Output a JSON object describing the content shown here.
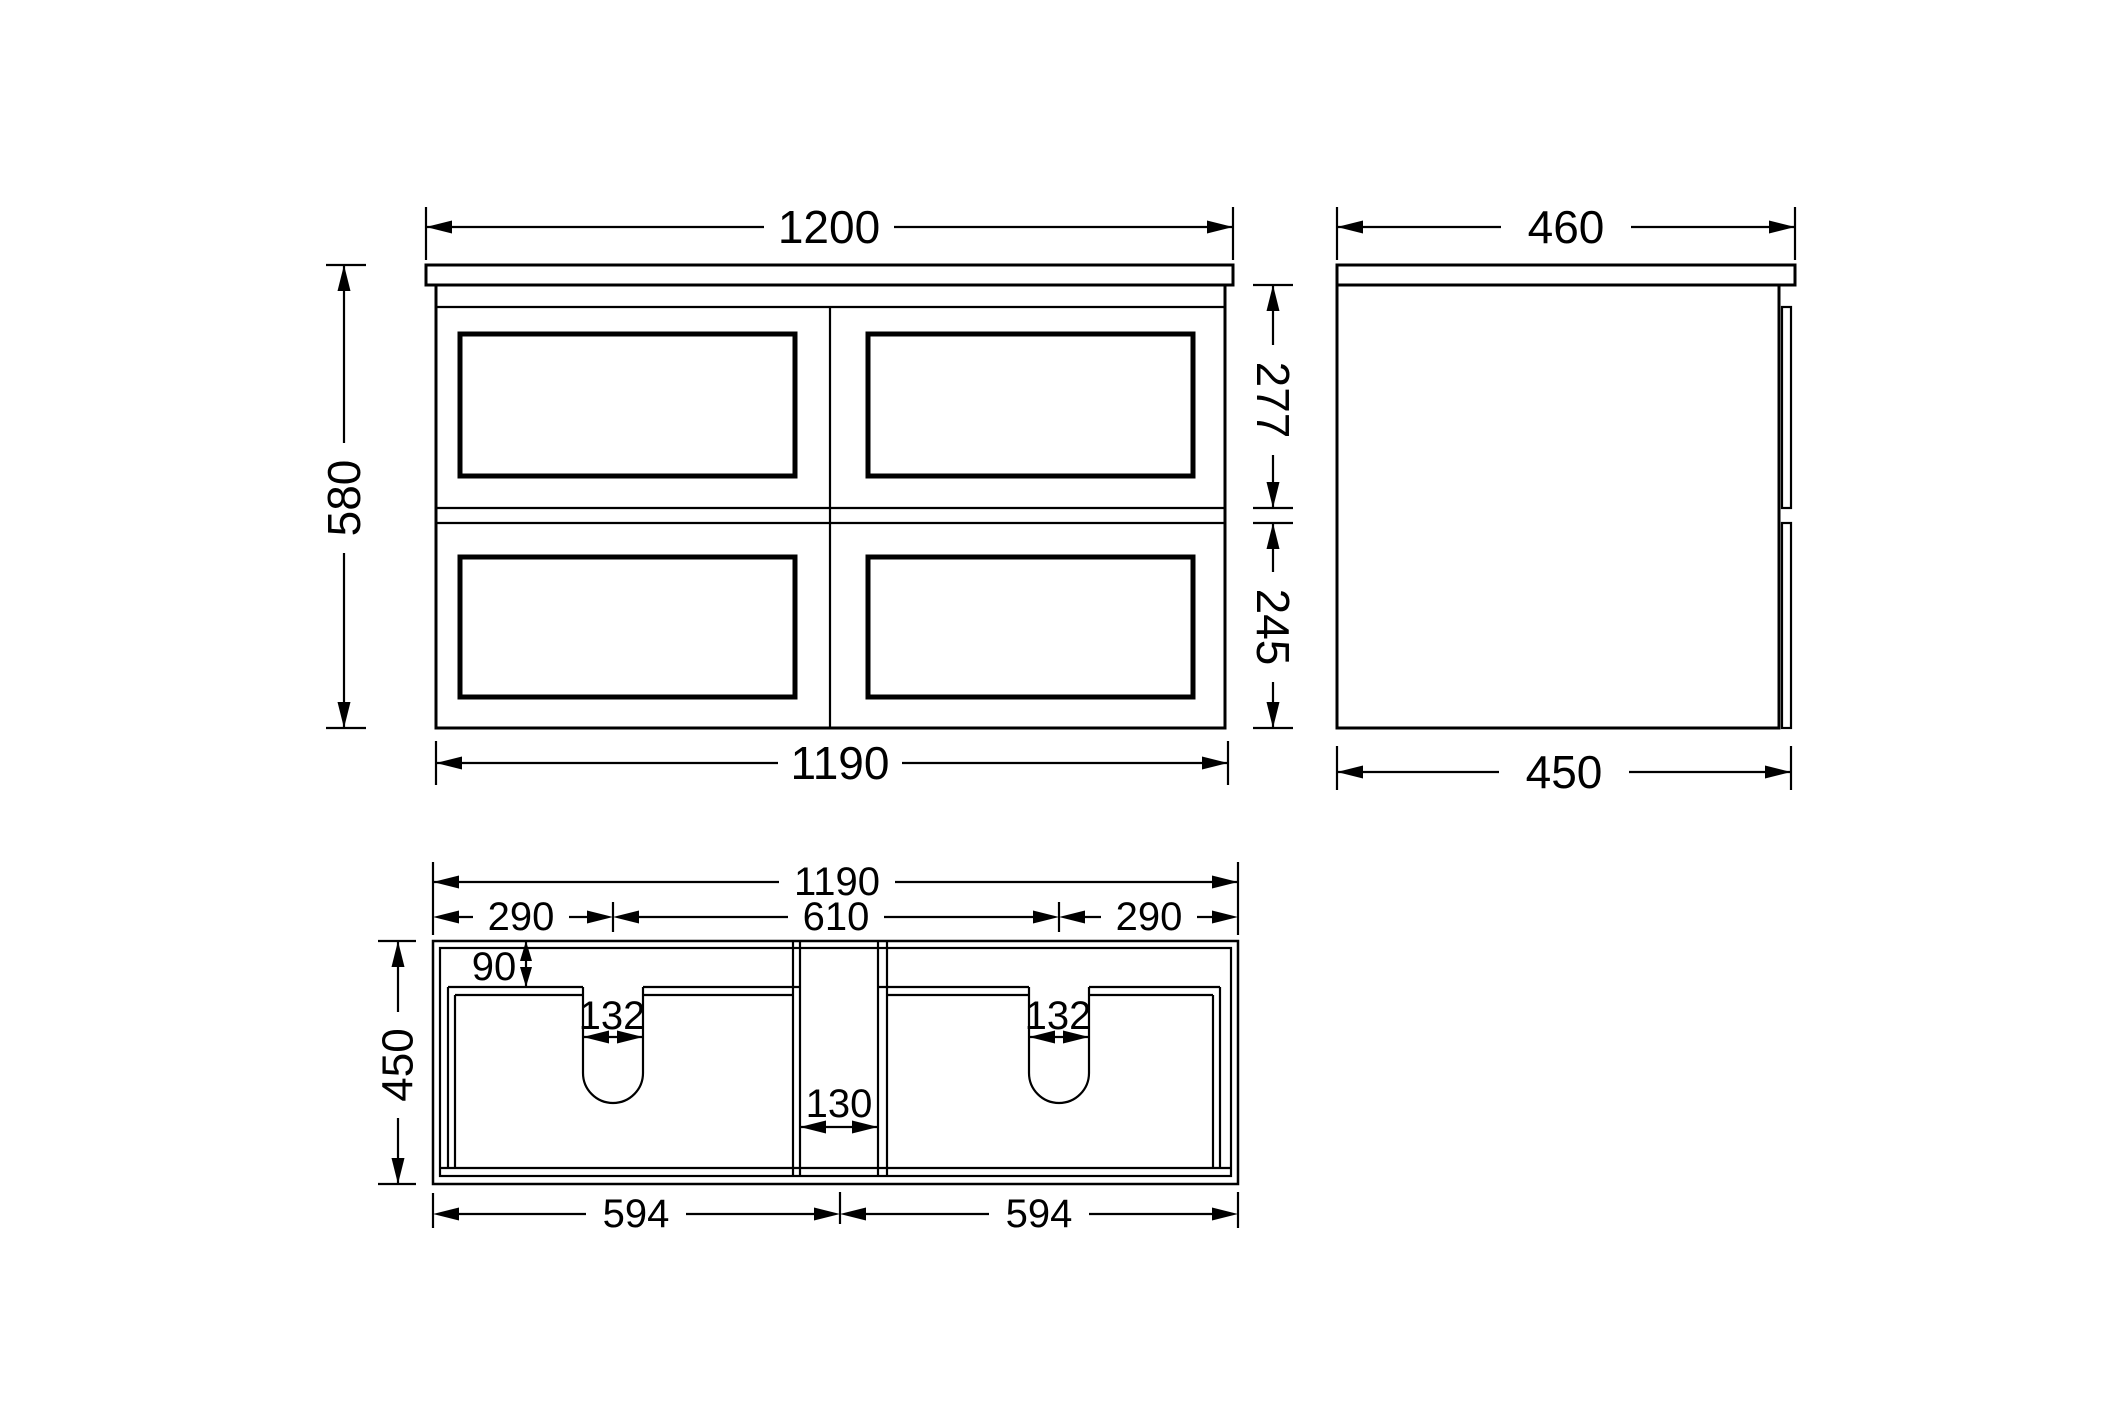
{
  "colors": {
    "background": "#ffffff",
    "line": "#000000",
    "text": "#000000"
  },
  "front": {
    "dim_width_top": "1200",
    "dim_height": "580",
    "dim_top_drawer": "277",
    "dim_bottom_drawer": "245",
    "dim_width_bottom": "1190"
  },
  "side": {
    "dim_depth_top": "460",
    "dim_depth_bottom": "450"
  },
  "plan": {
    "dim_width_top": "1190",
    "dim_left_to_notch": "290",
    "dim_notch_to_notch": "610",
    "dim_notch_to_right": "290",
    "dim_back_inset": "90",
    "dim_notch_width_left": "132",
    "dim_notch_width_right": "132",
    "dim_center_gap": "130",
    "dim_depth": "450",
    "dim_drawer_width_left": "594",
    "dim_drawer_width_right": "594"
  }
}
